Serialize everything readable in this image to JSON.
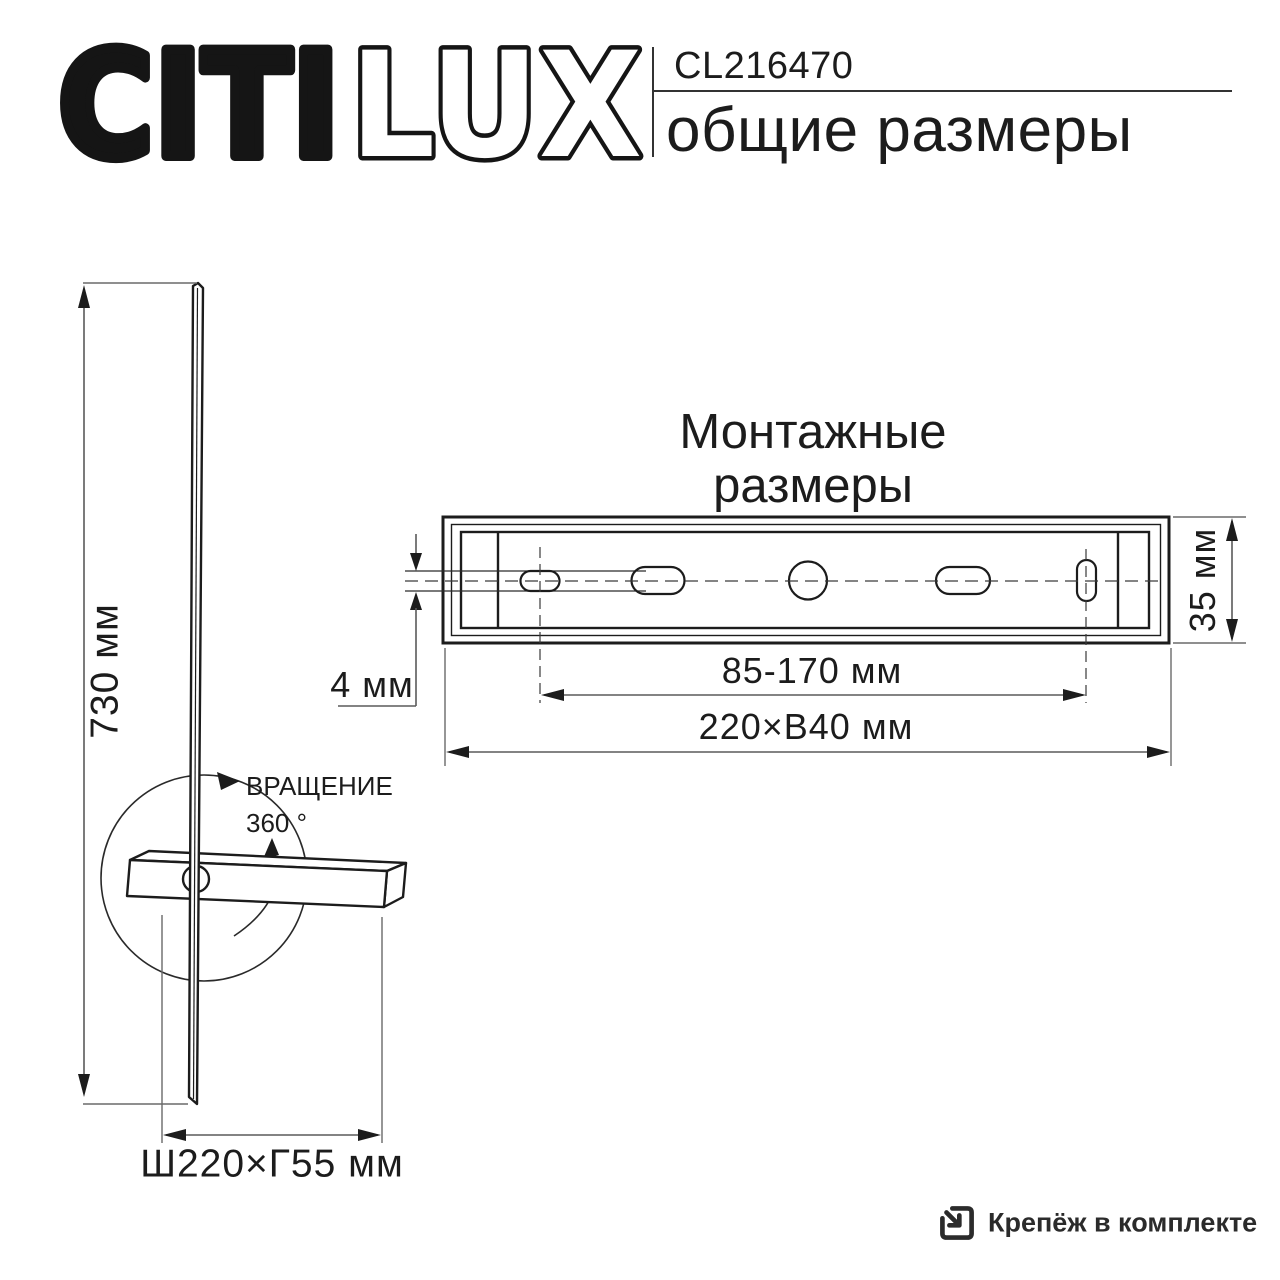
{
  "colors": {
    "background": "#ffffff",
    "ink": "#1c1c1c",
    "dimension_line": "#5a5a5a"
  },
  "brand": {
    "wordmark_solid": "CITI",
    "wordmark_outline": "LUX"
  },
  "header": {
    "model": "CL216470",
    "title": "общие размеры"
  },
  "side_view": {
    "height": "730 мм",
    "rotation_label": "ВРАЩЕНИЕ",
    "rotation_angle": "360 °",
    "footprint": "Ш220×Г55 мм"
  },
  "mounting": {
    "title_line1": "Монтажные",
    "title_line2": "размеры",
    "blade_thickness": "4 мм",
    "plate_height": "35 мм",
    "hole_spacing": "85-170 мм",
    "plate_width": "220×В40 мм"
  },
  "footer": {
    "icon": "fasteners-box-arrow-icon",
    "note": "Крепёж в комплекте"
  }
}
